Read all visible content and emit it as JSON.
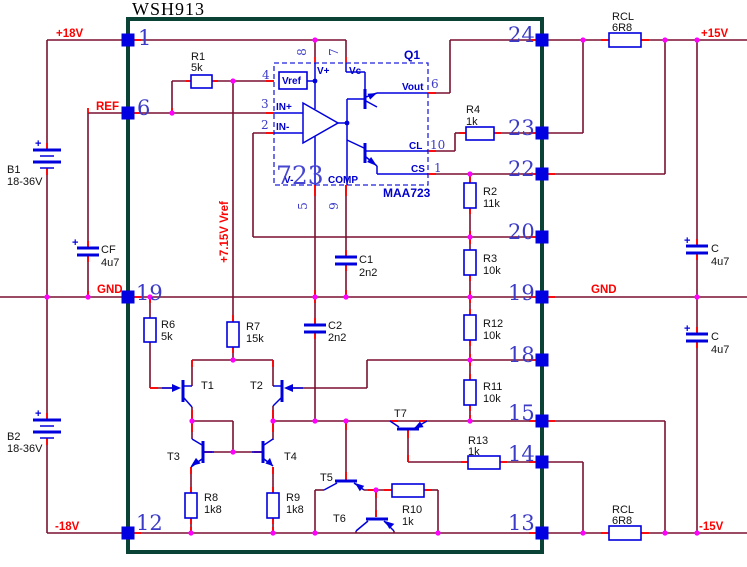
{
  "title": "WSH913",
  "ic723": {
    "designator": "Q1",
    "big_label": "723",
    "part": "MAA723",
    "pads": {
      "vref": "Vref",
      "vplus": "V+",
      "vc": "Vc",
      "vminus": "V-",
      "comp": "COMP",
      "in_plus": "IN+",
      "in_minus": "IN-",
      "vout": "Vout",
      "cl": "CL",
      "cs": "CS"
    },
    "pin_numbers": {
      "p1": "1",
      "p2": "2",
      "p3": "3",
      "p4": "4",
      "p5": "5",
      "p6": "6",
      "p7": "7",
      "p8": "8",
      "p9": "9",
      "p10": "10"
    }
  },
  "package": {
    "left_pins": {
      "p1": "1",
      "p6": "6",
      "p19": "19",
      "p12": "12"
    },
    "right_pins": {
      "p24": "24",
      "p23": "23",
      "p22": "22",
      "p20": "20",
      "p19": "19",
      "p18": "18",
      "p15": "15",
      "p14": "14",
      "p13": "13"
    }
  },
  "nets": {
    "p18v": "+18V",
    "ref": "REF",
    "gnd": "GND",
    "n18v": "-18V",
    "p15v": "+15V",
    "n15v": "-15V",
    "vref_rail": "+7.15V Vref"
  },
  "components": {
    "r1": {
      "name": "R1",
      "value": "5k"
    },
    "r2": {
      "name": "R2",
      "value": "11k"
    },
    "r3": {
      "name": "R3",
      "value": "10k"
    },
    "r4": {
      "name": "R4",
      "value": "1k"
    },
    "r6": {
      "name": "R6",
      "value": "5k"
    },
    "r7": {
      "name": "R7",
      "value": "15k"
    },
    "r8": {
      "name": "R8",
      "value": "1k8"
    },
    "r9": {
      "name": "R9",
      "value": "1k8"
    },
    "r10": {
      "name": "R10",
      "value": "1k"
    },
    "r11": {
      "name": "R11",
      "value": "10k"
    },
    "r12": {
      "name": "R12",
      "value": "10k"
    },
    "r13": {
      "name": "R13",
      "value": "1k"
    },
    "rcl": {
      "name": "RCL",
      "value": "6R8"
    },
    "c1": {
      "name": "C1",
      "value": "2n2"
    },
    "c2": {
      "name": "C2",
      "value": "2n2"
    },
    "cf": {
      "name": "CF",
      "value": "4u7"
    },
    "c": {
      "name": "C",
      "value": "4u7"
    },
    "b1": {
      "name": "B1",
      "value": "18-36V"
    },
    "b2": {
      "name": "B2",
      "value": "18-36V"
    },
    "plus": "+"
  },
  "transistors": {
    "t1": "T1",
    "t2": "T2",
    "t3": "T3",
    "t4": "T4",
    "t5": "T5",
    "t6": "T6",
    "t7": "T7"
  },
  "colors": {
    "wire": "#7a1130",
    "accent": "#ff0000",
    "component": "#0000dd",
    "junction": "#ff00ff",
    "package_outline": "#0b4236",
    "pin_fill": "#0000e0",
    "pin_number": "#3b3bc8",
    "net_label": "#ff0000",
    "label": "#111111"
  }
}
